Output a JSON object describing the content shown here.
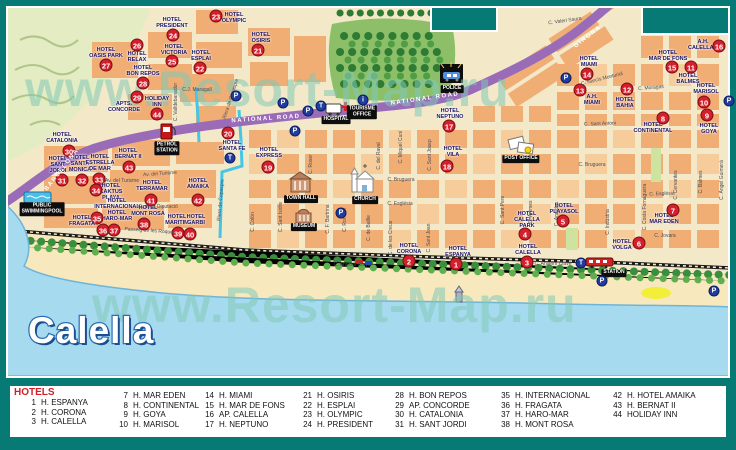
{
  "map_title": "Calella",
  "watermark": "www.Resort-Map.ru",
  "colors": {
    "frame_teal": "#087a75",
    "block_orange": "#f0ad74",
    "road_purple": "#9a6cb8",
    "sea_blue": "#a6dbef",
    "park_green": "#8cbf68",
    "badge_red": "#d41f2c",
    "badge_blue": "#1f3c9e",
    "title_blue": "#2e6cb5"
  },
  "roads": {
    "labels": [
      {
        "text": "NATIONAL ROAD",
        "x": 266,
        "y": 119,
        "rot": -4
      },
      {
        "text": "NATIONAL ROAD",
        "x": 425,
        "y": 99,
        "rot": -8
      },
      {
        "text": "GIRONA",
        "x": 588,
        "y": 37,
        "rot": -38
      },
      {
        "text": "BARCELONA",
        "x": 62,
        "y": 170,
        "rot": -52
      }
    ]
  },
  "map": {
    "hotels": [
      {
        "num": "1",
        "name": "HOTEL\nESPANYA",
        "lx": 458,
        "ly": 252,
        "bx": 456,
        "by": 264
      },
      {
        "num": "2",
        "name": "HOTEL\nCORONA",
        "lx": 409,
        "ly": 249,
        "bx": 409,
        "by": 261
      },
      {
        "num": "3",
        "name": "HOTEL\nCALELLA",
        "lx": 528,
        "ly": 250,
        "bx": 527,
        "by": 262
      },
      {
        "num": "4",
        "name": "HOTEL\nCALELLA\nPARK",
        "lx": 527,
        "ly": 220,
        "bx": 525,
        "by": 234
      },
      {
        "num": "5",
        "name": "HOTEL\nPLAYASOL",
        "lx": 564,
        "ly": 209,
        "bx": 563,
        "by": 221
      },
      {
        "num": "6",
        "name": "HOTEL\nVOLGA",
        "lx": 622,
        "ly": 245,
        "bx": 639,
        "by": 243
      },
      {
        "num": "7",
        "name": "HOTEL\nMAR EDEN",
        "lx": 664,
        "ly": 219,
        "bx": 673,
        "by": 210
      },
      {
        "num": "8",
        "name": "HOTEL\nCONTINENTAL",
        "lx": 653,
        "ly": 128,
        "bx": 663,
        "by": 118
      },
      {
        "num": "9",
        "name": "HOTEL\nGOYA",
        "lx": 709,
        "ly": 129,
        "bx": 707,
        "by": 115
      },
      {
        "num": "10",
        "name": "HOTEL\nMARISOL",
        "lx": 706,
        "ly": 89,
        "bx": 704,
        "by": 102
      },
      {
        "num": "11",
        "name": "HOTEL\nBALMES",
        "lx": 688,
        "ly": 79,
        "bx": 691,
        "by": 67
      },
      {
        "num": "12",
        "name": "HOTEL\nBAHIA",
        "lx": 625,
        "ly": 103,
        "bx": 627,
        "by": 89
      },
      {
        "num": "13",
        "name": "A.H.\nMIAMI",
        "lx": 592,
        "ly": 100,
        "bx": 580,
        "by": 90
      },
      {
        "num": "14",
        "name": "HOTEL\nMIAMI",
        "lx": 589,
        "ly": 62,
        "bx": 587,
        "by": 74
      },
      {
        "num": "15",
        "name": "HOTEL\nMAR DE FONS",
        "lx": 668,
        "ly": 56,
        "bx": 672,
        "by": 67
      },
      {
        "num": "16",
        "name": "A.H.\nCALELLA II",
        "lx": 703,
        "ly": 45,
        "bx": 719,
        "by": 46
      },
      {
        "num": "17",
        "name": "HOTEL\nNEPTUNO",
        "lx": 450,
        "ly": 114,
        "bx": 449,
        "by": 126
      },
      {
        "num": "18",
        "name": "HOTEL\nVILA",
        "lx": 453,
        "ly": 152,
        "bx": 447,
        "by": 166
      },
      {
        "num": "19",
        "name": "HOTEL\nEXPRESS",
        "lx": 269,
        "ly": 153,
        "bx": 268,
        "by": 167
      },
      {
        "num": "20",
        "name": "HOTEL\nSANTA FE",
        "lx": 232,
        "ly": 146,
        "bx": 228,
        "by": 133
      },
      {
        "num": "21",
        "name": "HOTEL\nOSIRIS",
        "lx": 261,
        "ly": 38,
        "bx": 258,
        "by": 50
      },
      {
        "num": "22",
        "name": "HOTEL\nESPLAI",
        "lx": 201,
        "ly": 56,
        "bx": 200,
        "by": 68
      },
      {
        "num": "23",
        "name": "HOTEL\nOLYMPIC",
        "lx": 234,
        "ly": 18,
        "bx": 216,
        "by": 16
      },
      {
        "num": "24",
        "name": "HOTEL\nPRESIDENT",
        "lx": 172,
        "ly": 23,
        "bx": 173,
        "by": 35
      },
      {
        "num": "25",
        "name": "HOTEL\nVICTORIA",
        "lx": 174,
        "ly": 50,
        "bx": 172,
        "by": 61
      },
      {
        "num": "26",
        "name": "HOTEL\nRELAX",
        "lx": 137,
        "ly": 57,
        "bx": 137,
        "by": 45
      },
      {
        "num": "27",
        "name": "HOTEL\nOASIS PARK",
        "lx": 106,
        "ly": 53,
        "bx": 106,
        "by": 65
      },
      {
        "num": "28",
        "name": "HOTEL\nBON REPOS",
        "lx": 143,
        "ly": 71,
        "bx": 143,
        "by": 83
      },
      {
        "num": "29",
        "name": "APTS.\nCONCORDE",
        "lx": 124,
        "ly": 107,
        "bx": 137,
        "by": 97
      },
      {
        "num": "30",
        "name": "HOTEL\nCATALONIA",
        "lx": 62,
        "ly": 138,
        "bx": 69,
        "by": 151
      },
      {
        "num": "31",
        "name": "HOTEL\nSANT\nJORDI",
        "lx": 58,
        "ly": 165,
        "bx": 62,
        "by": 180
      },
      {
        "num": "32",
        "name": "HOTEL\nSANTA\nMONICA",
        "lx": 80,
        "ly": 164,
        "bx": 82,
        "by": 180
      },
      {
        "num": "33",
        "name": "HOTEL\nESTRELLA\nDE MAR",
        "lx": 100,
        "ly": 163,
        "bx": 99,
        "by": 179
      },
      {
        "num": "34",
        "name": "HOTEL\nKAKTUS\nPLAYA",
        "lx": 111,
        "ly": 192,
        "bx": 96,
        "by": 190
      },
      {
        "num": "35",
        "name": "HOTEL\nINTERNACIONAL\nHOTEL\nHARO-MAR",
        "lx": 117,
        "ly": 210,
        "bx": 97,
        "by": 218
      },
      {
        "num": "36",
        "name": "HOTEL\nFRAGATA",
        "lx": 82,
        "ly": 221,
        "bx": 103,
        "by": 230
      },
      {
        "num": "37",
        "name": "",
        "lx": 0,
        "ly": 0,
        "bx": 114,
        "by": 230
      },
      {
        "num": "38",
        "name": "HOTEL\nMONT ROSA",
        "lx": 148,
        "ly": 211,
        "bx": 144,
        "by": 224
      },
      {
        "num": "39",
        "name": "HOTEL\nMARITIM",
        "lx": 177,
        "ly": 220,
        "bx": 178,
        "by": 233
      },
      {
        "num": "40",
        "name": "HOTEL\nGARBI",
        "lx": 196,
        "ly": 220,
        "bx": 190,
        "by": 234
      },
      {
        "num": "41",
        "name": "HOTEL\nTERRAMAR",
        "lx": 152,
        "ly": 186,
        "bx": 151,
        "by": 200
      },
      {
        "num": "42",
        "name": "HOTEL\nAMAIKA",
        "lx": 198,
        "ly": 184,
        "bx": 198,
        "by": 200
      },
      {
        "num": "43",
        "name": "HOTEL\nBERNAT II",
        "lx": 128,
        "ly": 154,
        "bx": 129,
        "by": 167
      },
      {
        "num": "44",
        "name": "HOLIDAY\nINN",
        "lx": 157,
        "ly": 102,
        "bx": 157,
        "by": 114
      }
    ],
    "streets": [
      {
        "name": "C.J. Maragall",
        "x": 197,
        "y": 90,
        "rot": 0
      },
      {
        "name": "Riera de Capaspre",
        "x": 231,
        "y": 99,
        "rot": -72
      },
      {
        "name": "C. Valldebanador",
        "x": 176,
        "y": 102,
        "rot": -90
      },
      {
        "name": "Riera de Capaspre",
        "x": 221,
        "y": 200,
        "rot": -85
      },
      {
        "name": "Av. del Turisme",
        "x": 122,
        "y": 181,
        "rot": 0
      },
      {
        "name": "Av. del Turisme",
        "x": 160,
        "y": 174,
        "rot": -4
      },
      {
        "name": "C. de la Diputació",
        "x": 158,
        "y": 207,
        "rot": 0
      },
      {
        "name": "Passeig de les Roques",
        "x": 150,
        "y": 231,
        "rot": 4
      },
      {
        "name": "C. Anselm Clavé",
        "x": 352,
        "y": 265,
        "rot": 0
      },
      {
        "name": "C. Anselm Clavé",
        "x": 553,
        "y": 264,
        "rot": 0
      },
      {
        "name": "C. Bruguera",
        "x": 401,
        "y": 180,
        "rot": 0
      },
      {
        "name": "C. Bruguera",
        "x": 592,
        "y": 165,
        "rot": 0
      },
      {
        "name": "C. Església",
        "x": 400,
        "y": 204,
        "rot": 0
      },
      {
        "name": "C. Església",
        "x": 662,
        "y": 194,
        "rot": -2
      },
      {
        "name": "C. Jovara",
        "x": 665,
        "y": 236,
        "rot": 0
      },
      {
        "name": "C. Sant Antoni",
        "x": 600,
        "y": 124,
        "rot": -2
      },
      {
        "name": "C. Narcís Monturiol",
        "x": 602,
        "y": 79,
        "rot": -14
      },
      {
        "name": "C. Moragas",
        "x": 651,
        "y": 88,
        "rot": -5
      },
      {
        "name": "C. Valeri Saura",
        "x": 565,
        "y": 21,
        "rot": -8
      },
      {
        "name": "C. Roser",
        "x": 311,
        "y": 164,
        "rot": -90
      },
      {
        "name": "C. del Raval",
        "x": 379,
        "y": 156,
        "rot": -90
      },
      {
        "name": "C. Miquel Cuní",
        "x": 401,
        "y": 147,
        "rot": -90
      },
      {
        "name": "C. Sant Josep",
        "x": 430,
        "y": 155,
        "rot": -90
      },
      {
        "name": "C. Sant Joan",
        "x": 429,
        "y": 238,
        "rot": -90
      },
      {
        "name": "C. de les Creus",
        "x": 391,
        "y": 238,
        "rot": -90
      },
      {
        "name": "C. de Batlle",
        "x": 369,
        "y": 228,
        "rot": -90
      },
      {
        "name": "C. Romaní",
        "x": 345,
        "y": 220,
        "rot": -90
      },
      {
        "name": "C. F. Bartrina",
        "x": 328,
        "y": 219,
        "rot": -90
      },
      {
        "name": "C. Sant Isidre",
        "x": 281,
        "y": 217,
        "rot": -90
      },
      {
        "name": "C. Colón",
        "x": 253,
        "y": 222,
        "rot": -90
      },
      {
        "name": "C. Sant Pere",
        "x": 503,
        "y": 210,
        "rot": -90
      },
      {
        "name": "C. Ànimes",
        "x": 531,
        "y": 212,
        "rot": -90
      },
      {
        "name": "C. Amadeu",
        "x": 557,
        "y": 214,
        "rot": -90
      },
      {
        "name": "C. Indústria",
        "x": 608,
        "y": 222,
        "rot": -90
      },
      {
        "name": "C. Costa Fornaguera",
        "x": 645,
        "y": 207,
        "rot": -90
      },
      {
        "name": "C. Cervantes",
        "x": 676,
        "y": 185,
        "rot": -90
      },
      {
        "name": "C. Balmes",
        "x": 701,
        "y": 182,
        "rot": -90
      },
      {
        "name": "C. Àngel Guimerà",
        "x": 722,
        "y": 180,
        "rot": -90
      }
    ],
    "places": [
      {
        "id": "hospital",
        "label": "HOSPITAL",
        "x": 336,
        "y": 120
      },
      {
        "id": "tourisme-office",
        "label": "TOURISME\nOFFICE",
        "x": 362,
        "y": 112
      },
      {
        "id": "police",
        "label": "POLICE",
        "x": 452,
        "y": 89
      },
      {
        "id": "post-office",
        "label": "POST OFFICE",
        "x": 521,
        "y": 159
      },
      {
        "id": "town-hall",
        "label": "TOWN HALL",
        "x": 301,
        "y": 199
      },
      {
        "id": "museum",
        "label": "MUSEUM",
        "x": 304,
        "y": 227
      },
      {
        "id": "church",
        "label": "CHURCH",
        "x": 365,
        "y": 200
      },
      {
        "id": "petrol-station",
        "label": "PETROL\nSTATION",
        "x": 167,
        "y": 148
      },
      {
        "id": "public-swimmingpool",
        "label": "PUBLIC\nSWIMMINGPOOL",
        "x": 42,
        "y": 209
      },
      {
        "id": "station",
        "label": "STATION",
        "x": 614,
        "y": 273
      }
    ],
    "parking": [
      [
        236,
        96
      ],
      [
        283,
        103
      ],
      [
        308,
        111
      ],
      [
        295,
        131
      ],
      [
        566,
        78
      ],
      [
        729,
        101
      ],
      [
        341,
        213
      ],
      [
        602,
        281
      ],
      [
        714,
        291
      ]
    ],
    "taxi": [
      [
        321,
        106
      ],
      [
        230,
        158
      ],
      [
        581,
        263
      ]
    ],
    "info": [
      [
        363,
        100
      ]
    ]
  },
  "legend": {
    "title": "HOTELS",
    "columns": [
      [
        {
          "num": "1",
          "name": "H. ESPANYA"
        },
        {
          "num": "2",
          "name": "H. CORONA"
        },
        {
          "num": "3",
          "name": "H. CALELLA"
        }
      ],
      [
        {
          "num": "7",
          "name": "H. MAR EDEN"
        },
        {
          "num": "8",
          "name": "H. CONTINENTAL"
        },
        {
          "num": "9",
          "name": "H. GOYA"
        },
        {
          "num": "10",
          "name": "H. MARISOL"
        }
      ],
      [
        {
          "num": "14",
          "name": "H. MIAMI"
        },
        {
          "num": "15",
          "name": "H. MAR DE FONS"
        },
        {
          "num": "16",
          "name": "AP. CALELLA"
        },
        {
          "num": "17",
          "name": "H. NEPTUNO"
        }
      ],
      [
        {
          "num": "21",
          "name": "H. OSIRIS"
        },
        {
          "num": "22",
          "name": "H. ESPLAI"
        },
        {
          "num": "23",
          "name": "H. OLYMPIC"
        },
        {
          "num": "24",
          "name": "H. PRESIDENT"
        }
      ],
      [
        {
          "num": "28",
          "name": "H. BON REPOS"
        },
        {
          "num": "29",
          "name": "AP. CONCORDE"
        },
        {
          "num": "30",
          "name": "H. CATALONIA"
        },
        {
          "num": "31",
          "name": "H. SANT JORDI"
        }
      ],
      [
        {
          "num": "35",
          "name": "H. INTERNACIONAL"
        },
        {
          "num": "36",
          "name": "H. FRAGATA"
        },
        {
          "num": "37",
          "name": "H. HARO-MAR"
        },
        {
          "num": "38",
          "name": "H. MONT ROSA"
        }
      ],
      [
        {
          "num": "42",
          "name": "H. HOTEL AMAIKA"
        },
        {
          "num": "43",
          "name": "H. BERNAT II"
        },
        {
          "num": "44",
          "name": "HOLIDAY INN"
        }
      ]
    ]
  }
}
